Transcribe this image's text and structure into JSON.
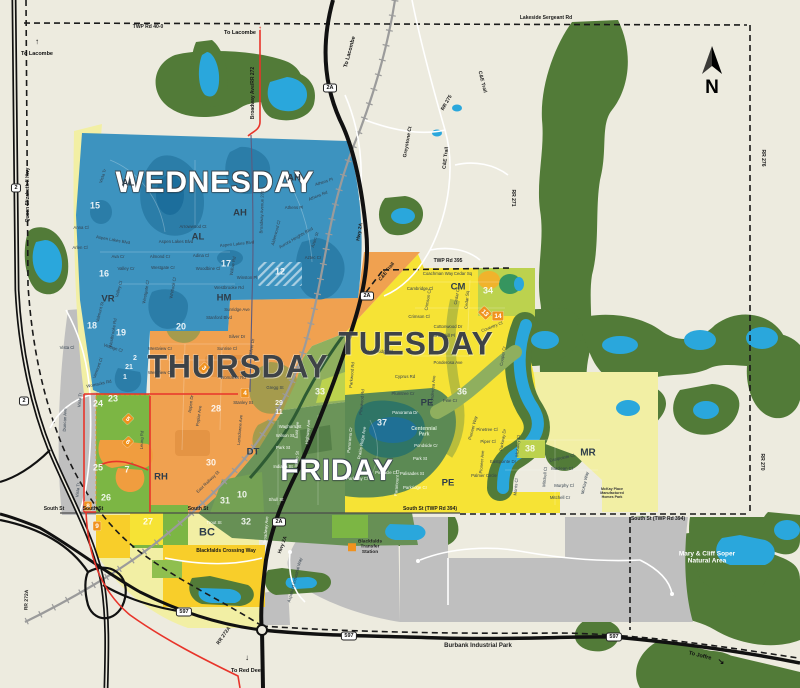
{
  "map": {
    "compass": {
      "letter": "N"
    },
    "colors": {
      "wednesday": "#3D93BF",
      "thursday": "#F0A150",
      "tuesday": "#F6E335",
      "friday": "#6B9459",
      "water": "#2AA7DC",
      "park": "#527B38",
      "marker": "#F0921E",
      "background": "#EDEBDF"
    },
    "day_labels": [
      {
        "t": "WEDNESDAY",
        "x": 215,
        "y": 182,
        "s": 30,
        "c": "light"
      },
      {
        "t": "THURSDAY",
        "x": 238,
        "y": 367,
        "s": 32,
        "c": "dark"
      },
      {
        "t": "TUESDAY",
        "x": 416,
        "y": 344,
        "s": 32,
        "c": "dark"
      },
      {
        "t": "FRIDAY",
        "x": 337,
        "y": 470,
        "s": 30,
        "c": "light"
      }
    ],
    "neighborhood_codes": [
      {
        "t": "AL",
        "x": 128,
        "y": 183
      },
      {
        "t": "AH",
        "x": 294,
        "y": 178
      },
      {
        "t": "AH",
        "x": 240,
        "y": 213
      },
      {
        "t": "AL",
        "x": 198,
        "y": 237
      },
      {
        "t": "VR",
        "x": 108,
        "y": 299
      },
      {
        "t": "HM",
        "x": 224,
        "y": 298
      },
      {
        "t": "RH",
        "x": 161,
        "y": 477
      },
      {
        "t": "DT",
        "x": 253,
        "y": 452
      },
      {
        "t": "BC",
        "x": 207,
        "y": 532,
        "s": 11
      },
      {
        "t": "CM",
        "x": 458,
        "y": 287
      },
      {
        "t": "PE",
        "x": 427,
        "y": 403
      },
      {
        "t": "PE",
        "x": 448,
        "y": 483
      },
      {
        "t": "MR",
        "x": 588,
        "y": 453,
        "s": 10
      }
    ],
    "zone_numbers": [
      {
        "t": "15",
        "x": 95,
        "y": 206
      },
      {
        "t": "16",
        "x": 104,
        "y": 274
      },
      {
        "t": "17",
        "x": 226,
        "y": 264
      },
      {
        "t": "12",
        "x": 280,
        "y": 272
      },
      {
        "t": "18",
        "x": 92,
        "y": 326
      },
      {
        "t": "19",
        "x": 121,
        "y": 333
      },
      {
        "t": "20",
        "x": 181,
        "y": 327
      },
      {
        "t": "2",
        "x": 135,
        "y": 358,
        "s": 7
      },
      {
        "t": "21",
        "x": 129,
        "y": 367,
        "s": 7
      },
      {
        "t": "1",
        "x": 125,
        "y": 377,
        "s": 7
      },
      {
        "t": "23",
        "x": 113,
        "y": 399
      },
      {
        "t": "24",
        "x": 98,
        "y": 404
      },
      {
        "t": "25",
        "x": 98,
        "y": 468
      },
      {
        "t": "7",
        "x": 127,
        "y": 470
      },
      {
        "t": "26",
        "x": 106,
        "y": 498
      },
      {
        "t": "27",
        "x": 148,
        "y": 522
      },
      {
        "t": "28",
        "x": 216,
        "y": 409
      },
      {
        "t": "29",
        "x": 279,
        "y": 403,
        "s": 7
      },
      {
        "t": "11",
        "x": 279,
        "y": 412,
        "s": 7
      },
      {
        "t": "30",
        "x": 211,
        "y": 463
      },
      {
        "t": "31",
        "x": 225,
        "y": 501
      },
      {
        "t": "10",
        "x": 242,
        "y": 495
      },
      {
        "t": "32",
        "x": 246,
        "y": 522
      },
      {
        "t": "33",
        "x": 320,
        "y": 392
      },
      {
        "t": "34",
        "x": 488,
        "y": 291
      },
      {
        "t": "36",
        "x": 462,
        "y": 392
      },
      {
        "t": "37",
        "x": 382,
        "y": 423
      },
      {
        "t": "38",
        "x": 530,
        "y": 449
      }
    ],
    "route_markers": [
      {
        "t": "3",
        "x": 204,
        "y": 368,
        "r": 45
      },
      {
        "t": "4",
        "x": 245,
        "y": 393,
        "r": 0
      },
      {
        "t": "5",
        "x": 128,
        "y": 419,
        "r": 45
      },
      {
        "t": "6",
        "x": 128,
        "y": 442,
        "r": 45
      },
      {
        "t": "8",
        "x": 88,
        "y": 506,
        "r": 0
      },
      {
        "t": "9",
        "x": 97,
        "y": 526,
        "r": 0
      },
      {
        "t": "13",
        "x": 485,
        "y": 313,
        "r": 45
      },
      {
        "t": "14",
        "x": 498,
        "y": 316,
        "r": 0
      }
    ],
    "highway_shields": [
      {
        "t": "2",
        "x": 16,
        "y": 188
      },
      {
        "t": "2",
        "x": 24,
        "y": 401
      },
      {
        "t": "2A",
        "x": 330,
        "y": 88
      },
      {
        "t": "2A",
        "x": 367,
        "y": 296
      },
      {
        "t": "2A",
        "x": 279,
        "y": 522
      },
      {
        "t": "597",
        "x": 184,
        "y": 612
      },
      {
        "t": "597",
        "x": 349,
        "y": 636
      },
      {
        "t": "597",
        "x": 614,
        "y": 637
      }
    ],
    "road_labels": [
      {
        "t": "TWP Rd 40-0",
        "x": 148,
        "y": 27,
        "r": 0
      },
      {
        "t": "Lakeside Sergeant Rd",
        "x": 546,
        "y": 18,
        "r": 0
      },
      {
        "t": "Broadway Ave/RR 272",
        "x": 253,
        "y": 93,
        "r": -90
      },
      {
        "t": "Queen Elizabeth II Hwy",
        "x": 28,
        "y": 195,
        "r": -90
      },
      {
        "t": "C&E Trail",
        "x": 482,
        "y": 82,
        "r": 76
      },
      {
        "t": "C&E Trail",
        "x": 446,
        "y": 158,
        "r": -83
      },
      {
        "t": "C&E Trail",
        "x": 387,
        "y": 272,
        "r": -52
      },
      {
        "t": "RR 275",
        "x": 447,
        "y": 103,
        "r": -60
      },
      {
        "t": "Greystone Ct",
        "x": 408,
        "y": 142,
        "r": -80
      },
      {
        "t": "RR 276",
        "x": 763,
        "y": 158,
        "r": 90
      },
      {
        "t": "RR 271",
        "x": 513,
        "y": 198,
        "r": 90
      },
      {
        "t": "RR 270",
        "x": 762,
        "y": 462,
        "r": 90
      },
      {
        "t": "TWP Rd 395",
        "x": 448,
        "y": 261,
        "r": 0
      },
      {
        "t": "South St",
        "x": 54,
        "y": 509,
        "r": 0
      },
      {
        "t": "South St",
        "x": 93,
        "y": 509,
        "r": 0
      },
      {
        "t": "South St",
        "x": 198,
        "y": 509,
        "r": 0
      },
      {
        "t": "South St (TWP Rd 394)",
        "x": 430,
        "y": 509,
        "r": 0
      },
      {
        "t": "South St (TWP Rd 394)",
        "x": 658,
        "y": 519,
        "r": 0
      },
      {
        "t": "Hwy 2A",
        "x": 360,
        "y": 232,
        "r": -80
      },
      {
        "t": "Hwy 2A",
        "x": 283,
        "y": 545,
        "r": -70
      },
      {
        "t": "RR 272A",
        "x": 224,
        "y": 636,
        "r": -55
      },
      {
        "t": "RR 272A",
        "x": 27,
        "y": 600,
        "r": -88
      },
      {
        "t": "Blackfalds Crossing Way",
        "x": 226,
        "y": 551,
        "r": 0
      }
    ],
    "street_labels": [
      {
        "t": "Vista Tr",
        "x": 103,
        "y": 176,
        "r": -72
      },
      {
        "t": "Anna Cl",
        "x": 81,
        "y": 228,
        "r": 0
      },
      {
        "t": "Arlen Cl",
        "x": 80,
        "y": 248,
        "r": 0
      },
      {
        "t": "Ava Cr",
        "x": 118,
        "y": 257,
        "r": 0
      },
      {
        "t": "Aspen Lakes Blvd",
        "x": 113,
        "y": 240,
        "r": 10
      },
      {
        "t": "Aspen Lakes Blvd",
        "x": 176,
        "y": 242,
        "r": 0
      },
      {
        "t": "Aspen Lakes Blvd",
        "x": 237,
        "y": 244,
        "r": -6
      },
      {
        "t": "Arrowwood Ct",
        "x": 193,
        "y": 227,
        "r": 0
      },
      {
        "t": "Almond Cr",
        "x": 160,
        "y": 257,
        "r": 0
      },
      {
        "t": "Adina Cl",
        "x": 201,
        "y": 256,
        "r": 0
      },
      {
        "t": "Willow Rd",
        "x": 233,
        "y": 266,
        "r": -80
      },
      {
        "t": "Valley Cr",
        "x": 126,
        "y": 269,
        "r": 0
      },
      {
        "t": "Valley Cl",
        "x": 119,
        "y": 289,
        "r": -75
      },
      {
        "t": "Westgate Cr",
        "x": 163,
        "y": 268,
        "r": 0
      },
      {
        "t": "Westgate Cl",
        "x": 146,
        "y": 292,
        "r": -80
      },
      {
        "t": "Whitlock Cl",
        "x": 173,
        "y": 288,
        "r": -80
      },
      {
        "t": "Woodbine Cl",
        "x": 208,
        "y": 269,
        "r": 0
      },
      {
        "t": "Winston Pl",
        "x": 247,
        "y": 278,
        "r": 0
      },
      {
        "t": "Westbrooke Rd",
        "x": 229,
        "y": 288,
        "r": 0
      },
      {
        "t": "Westbrooke Rd",
        "x": 113,
        "y": 333,
        "r": -80
      },
      {
        "t": "Athens Pl",
        "x": 324,
        "y": 182,
        "r": -18
      },
      {
        "t": "Athens Rd",
        "x": 318,
        "y": 196,
        "r": -22
      },
      {
        "t": "Athens Pl",
        "x": 294,
        "y": 208,
        "r": 0
      },
      {
        "t": "Aurora Heights Blvd",
        "x": 296,
        "y": 238,
        "r": -30
      },
      {
        "t": "Alderwood Cl",
        "x": 276,
        "y": 233,
        "r": -75
      },
      {
        "t": "Aztec St",
        "x": 315,
        "y": 240,
        "r": -72
      },
      {
        "t": "Aztec Cr",
        "x": 313,
        "y": 258,
        "r": 0
      },
      {
        "t": "Broadway Avenue 272",
        "x": 262,
        "y": 212,
        "r": -88
      },
      {
        "t": "Valmont St",
        "x": 100,
        "y": 312,
        "r": -75
      },
      {
        "t": "Vintage Cl",
        "x": 113,
        "y": 348,
        "r": 18
      },
      {
        "t": "Vermont Cl",
        "x": 98,
        "y": 368,
        "r": -70
      },
      {
        "t": "Vista Cl",
        "x": 67,
        "y": 348,
        "r": 0
      },
      {
        "t": "Womacks Rd",
        "x": 99,
        "y": 384,
        "r": -12
      },
      {
        "t": "Sunridge Ave",
        "x": 237,
        "y": 310,
        "r": 0
      },
      {
        "t": "Stanford Blvd",
        "x": 219,
        "y": 318,
        "r": 0
      },
      {
        "t": "Silver Dr",
        "x": 237,
        "y": 337,
        "r": 0
      },
      {
        "t": "Silver Dr",
        "x": 252,
        "y": 347,
        "r": -80
      },
      {
        "t": "Sunrise Cl",
        "x": 227,
        "y": 349,
        "r": 0
      },
      {
        "t": "Westview Cr",
        "x": 160,
        "y": 349,
        "r": 0
      },
      {
        "t": "Westview Cr",
        "x": 160,
        "y": 373,
        "r": 0
      },
      {
        "t": "Womacks Rd",
        "x": 233,
        "y": 378,
        "r": 0
      },
      {
        "t": "Aspen Dr",
        "x": 191,
        "y": 404,
        "r": -82
      },
      {
        "t": "Poplar Ave",
        "x": 199,
        "y": 416,
        "r": -82
      },
      {
        "t": "Stanley St",
        "x": 243,
        "y": 403,
        "r": 0
      },
      {
        "t": "Gregg St",
        "x": 275,
        "y": 388,
        "r": 0
      },
      {
        "t": "Lansdowne Ave",
        "x": 240,
        "y": 430,
        "r": -85
      },
      {
        "t": "Leung Rd",
        "x": 142,
        "y": 440,
        "r": -88
      },
      {
        "t": "East Railway St",
        "x": 208,
        "y": 482,
        "r": -44
      },
      {
        "t": "Coachman Way",
        "x": 438,
        "y": 274,
        "r": 0
      },
      {
        "t": "Cedar Sq",
        "x": 463,
        "y": 274,
        "r": 0
      },
      {
        "t": "Cedar Sq",
        "x": 467,
        "y": 300,
        "r": -85
      },
      {
        "t": "Cedar Cr",
        "x": 457,
        "y": 296,
        "r": -80
      },
      {
        "t": "Cambridge Cl",
        "x": 420,
        "y": 289,
        "r": 0
      },
      {
        "t": "Crimson Cl",
        "x": 419,
        "y": 317,
        "r": 0
      },
      {
        "t": "Crimson Cl",
        "x": 428,
        "y": 300,
        "r": -80
      },
      {
        "t": "Cottonwood Dr",
        "x": 448,
        "y": 327,
        "r": 0
      },
      {
        "t": "Churchill Pl",
        "x": 444,
        "y": 336,
        "r": 0
      },
      {
        "t": "Coventry Cl",
        "x": 492,
        "y": 327,
        "r": -22
      },
      {
        "t": "Cooper Cr",
        "x": 503,
        "y": 356,
        "r": -80
      },
      {
        "t": "Ponderosa Ave",
        "x": 448,
        "y": 363,
        "r": 0
      },
      {
        "t": "Ponderosa Ave",
        "x": 433,
        "y": 390,
        "r": -85
      },
      {
        "t": "Cyprus Rd",
        "x": 405,
        "y": 377,
        "r": 0
      },
      {
        "t": "Plumtree Cr",
        "x": 403,
        "y": 394,
        "r": 0
      },
      {
        "t": "Pine Cr",
        "x": 450,
        "y": 401,
        "r": 0
      },
      {
        "t": "Pioneer Way",
        "x": 473,
        "y": 428,
        "r": -75
      },
      {
        "t": "Pinetree Cl",
        "x": 487,
        "y": 430,
        "r": 0
      },
      {
        "t": "Piper Cl",
        "x": 488,
        "y": 442,
        "r": 0
      },
      {
        "t": "Parkway Dr",
        "x": 503,
        "y": 440,
        "r": -80
      },
      {
        "t": "Pioneer Ave",
        "x": 482,
        "y": 462,
        "r": -85
      },
      {
        "t": "Eastpointe Dr",
        "x": 503,
        "y": 462,
        "r": 0
      },
      {
        "t": "Palmer Circle",
        "x": 484,
        "y": 476,
        "r": 0
      },
      {
        "t": "McAuley Cl",
        "x": 518,
        "y": 446,
        "r": -85
      },
      {
        "t": "Morris Cl",
        "x": 516,
        "y": 487,
        "r": -85
      },
      {
        "t": "Mitchell Cl",
        "x": 545,
        "y": 477,
        "r": -85
      },
      {
        "t": "Eastpointe Cl",
        "x": 562,
        "y": 458,
        "r": -12
      },
      {
        "t": "Maclean Cl",
        "x": 562,
        "y": 469,
        "r": 0
      },
      {
        "t": "Murphy Cl",
        "x": 564,
        "y": 486,
        "r": 0
      },
      {
        "t": "Mitchell Cr",
        "x": 560,
        "y": 498,
        "r": 0
      },
      {
        "t": "McKay Way",
        "x": 585,
        "y": 483,
        "r": -78
      },
      {
        "t": "Prairie Ridge Cl",
        "x": 378,
        "y": 352,
        "r": 0
      },
      {
        "t": "Parkwood Rd",
        "x": 352,
        "y": 375,
        "r": -85
      },
      {
        "t": "Pinewood Rd",
        "x": 362,
        "y": 402,
        "r": -85
      },
      {
        "t": "Waghorn St",
        "x": 290,
        "y": 427,
        "r": 0,
        "l": 1
      },
      {
        "t": "Wilson St",
        "x": 285,
        "y": 436,
        "r": 0,
        "l": 1
      },
      {
        "t": "Park St",
        "x": 283,
        "y": 448,
        "r": 0,
        "l": 1
      },
      {
        "t": "Indiana St",
        "x": 283,
        "y": 467,
        "r": 0,
        "l": 1
      },
      {
        "t": "Shull St",
        "x": 276,
        "y": 500,
        "r": 0,
        "l": 1
      },
      {
        "t": "East Ave",
        "x": 297,
        "y": 430,
        "r": -85,
        "l": 1
      },
      {
        "t": "Highway Ave",
        "x": 308,
        "y": 432,
        "r": -85,
        "l": 1
      },
      {
        "t": "Minto St",
        "x": 297,
        "y": 459,
        "r": -85,
        "l": 1
      },
      {
        "t": "Panorama Dr",
        "x": 405,
        "y": 413,
        "r": 0,
        "l": 1
      },
      {
        "t": "Pondside Cr",
        "x": 426,
        "y": 446,
        "r": 0,
        "l": 1
      },
      {
        "t": "Park St",
        "x": 420,
        "y": 459,
        "r": 0,
        "l": 1
      },
      {
        "t": "Palisades St",
        "x": 412,
        "y": 474,
        "r": 0,
        "l": 1
      },
      {
        "t": "Parkridge Cr",
        "x": 415,
        "y": 488,
        "r": 0,
        "l": 1
      },
      {
        "t": "Pinnacle Cl",
        "x": 386,
        "y": 473,
        "r": 0,
        "l": 1
      },
      {
        "t": "Parkway Cl",
        "x": 357,
        "y": 479,
        "r": 0,
        "l": 1
      },
      {
        "t": "Paramount Cl",
        "x": 397,
        "y": 483,
        "r": -85,
        "l": 1
      },
      {
        "t": "Panorama Cr",
        "x": 350,
        "y": 440,
        "r": -85,
        "l": 1
      },
      {
        "t": "Prairie Ridge Ave",
        "x": 362,
        "y": 443,
        "r": -80,
        "l": 1
      },
      {
        "t": "Trout St",
        "x": 214,
        "y": 523,
        "r": 0,
        "l": 1
      },
      {
        "t": "Broadway Ave",
        "x": 266,
        "y": 530,
        "r": -85,
        "l": 1
      },
      {
        "t": "Aspelund Industrial Way",
        "x": 295,
        "y": 580,
        "r": -75
      },
      {
        "t": "Duncan Ave",
        "x": 65,
        "y": 420,
        "r": -88
      },
      {
        "t": "Vista Tr",
        "x": 80,
        "y": 400,
        "r": -85
      },
      {
        "t": "Vista Tr",
        "x": 78,
        "y": 490,
        "r": -85
      }
    ],
    "place_labels": [
      {
        "t": "Mary & Cliff Soper\nNatural Area",
        "x": 707,
        "y": 557,
        "c": "white",
        "s": 6.5
      },
      {
        "t": "Centennial\nPark",
        "x": 424,
        "y": 432,
        "c": "park",
        "s": 5
      },
      {
        "t": "Blackfalds\nTransfer\nStation",
        "x": 365,
        "y": 547,
        "c": "dark",
        "s": 4.8,
        "sw": 1
      },
      {
        "t": "Burbank Industrial Park",
        "x": 478,
        "y": 645,
        "c": "dark",
        "s": 6
      },
      {
        "t": "McKay Place\nManufactured\nHomes Park",
        "x": 612,
        "y": 493,
        "c": "tiny",
        "s": 3.6
      }
    ],
    "direction_labels": [
      {
        "t": "To Lacombe",
        "x": 37,
        "y": 54,
        "r": 0
      },
      {
        "t": "To Lacombe",
        "x": 240,
        "y": 33,
        "r": 0
      },
      {
        "t": "To Lacombe",
        "x": 350,
        "y": 52,
        "r": -75
      },
      {
        "t": "To Red Deer",
        "x": 247,
        "y": 671,
        "r": 0
      },
      {
        "t": "To Joffre",
        "x": 700,
        "y": 656,
        "r": 14
      }
    ],
    "glyphs": [
      {
        "t": "↑",
        "x": 37,
        "y": 42,
        "r": 0
      },
      {
        "t": "↑",
        "x": 260,
        "y": 29,
        "r": 0,
        "col": "#E8342A"
      },
      {
        "t": "↓",
        "x": 247,
        "y": 658,
        "r": 0
      },
      {
        "t": "↘",
        "x": 721,
        "y": 662,
        "r": 0
      }
    ]
  }
}
